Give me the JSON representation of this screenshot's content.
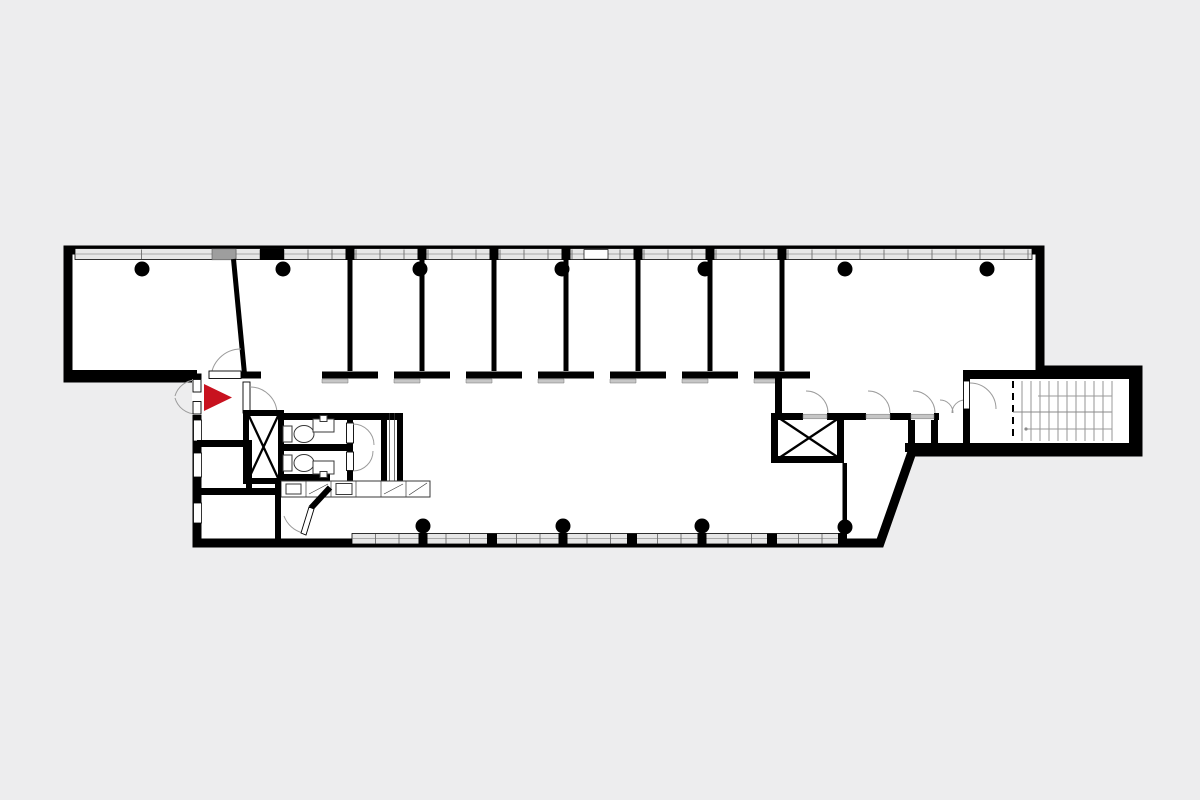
{
  "figure": {
    "kind": "architectural-floor-plan",
    "orientation": "elongated-horizontal-building",
    "entrance_marker": "red-triangle-pointing-right"
  },
  "colors": {
    "background": "#ededee",
    "floor": "#ffffff",
    "wall": "#000000",
    "glass": "#e7e7e7",
    "frame": "#6e6e6e",
    "sill": "#c6c6c6",
    "arc": "#9b9b9b",
    "fixture": "#3a3a3a",
    "stairline": "#8a8a8a",
    "accent": "#c8121f",
    "panel": "#9e9e9e"
  },
  "elements": {
    "columns_top_row": 7,
    "columns_bottom_row": 4,
    "office_partitions": 7,
    "slanted_partitions": 1,
    "wc_stalls": 2,
    "toilets": 2,
    "stall_sinks": 2,
    "vanity_counter_cells": 6,
    "x_braced_shafts": 2,
    "stair_treads": 11,
    "door_swings": 14,
    "window_bands": [
      "top-facade",
      "bottom-facade",
      "left-lower-facade"
    ]
  }
}
